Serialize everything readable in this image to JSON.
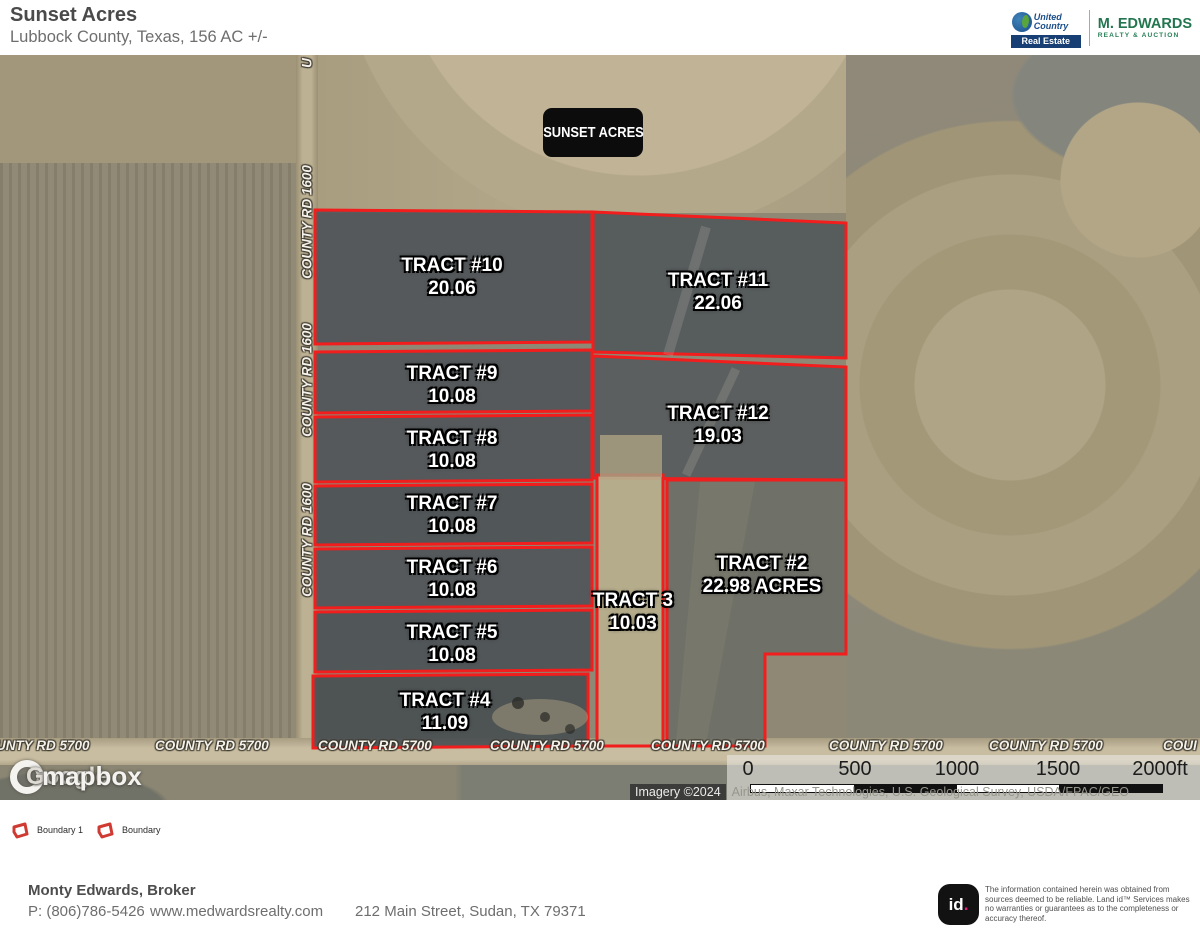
{
  "header": {
    "title": "Sunset Acres",
    "subtitle": "Lubbock County, Texas, 156 AC +/-",
    "logos": {
      "united_line1": "United",
      "united_line2": "Country",
      "united_line3": "Real Estate",
      "medwards_line1": "M. EDWARDS",
      "medwards_line2": "REALTY & AUCTION"
    }
  },
  "map": {
    "badge": "SUNSET ACRES",
    "tracts": [
      {
        "name": "TRACT #10",
        "acres": "20.06"
      },
      {
        "name": "TRACT #11",
        "acres": "22.06"
      },
      {
        "name": "TRACT #9",
        "acres": "10.08"
      },
      {
        "name": "TRACT #12",
        "acres": "19.03"
      },
      {
        "name": "TRACT #8",
        "acres": "10.08"
      },
      {
        "name": "TRACT #7",
        "acres": "10.08"
      },
      {
        "name": "TRACT #6",
        "acres": "10.08"
      },
      {
        "name": "TRACT #5",
        "acres": "10.08"
      },
      {
        "name": "TRACT #4",
        "acres": "11.09"
      },
      {
        "name": "TRACT 3",
        "acres": "10.03"
      },
      {
        "name": "TRACT #2",
        "acres": "22.98 ACRES"
      }
    ],
    "roads": {
      "vertical_label": "COUNTY RD 1600",
      "vertical_label_top_clipped": "U",
      "horizontal_label": "COUNTY RD 5700",
      "horizontal_label_left_clipped": "UNTY RD 5700",
      "horizontal_label_right_clipped": "COUI"
    },
    "watermark": {
      "google_text": "Google",
      "mapbox_text": "mapbox"
    },
    "scalebar": {
      "ticks": [
        "0",
        "500",
        "1000",
        "1500",
        "2000ft"
      ]
    },
    "attribution": {
      "imagery": "Imagery ©2024",
      "sources": "Airbus, Maxar Technologies, U.S. Geological Survey, USDA/FPAC/GEO"
    }
  },
  "legend": {
    "items": [
      {
        "label": "Boundary 1"
      },
      {
        "label": "Boundary"
      }
    ]
  },
  "footer": {
    "broker": "Monty Edwards, Broker",
    "phone": "P: (806)786-5426",
    "website": "www.medwardsrealty.com",
    "address": "212 Main Street, Sudan, TX 79371",
    "landid_logo_id": "id",
    "landid_logo_dot": ".",
    "disclaimer_line1": "The information contained herein was obtained from sources deemed to be reliable.",
    "disclaimer_line2": "Land id™ Services makes no warranties or guarantees as to the completeness or accuracy thereof."
  },
  "colors": {
    "boundary_red": "#f21d1d",
    "badge_black": "#0c0c0c",
    "landid_dot_pink": "#e61e7b",
    "united_country_blue": "#1b4e8a",
    "medwards_green": "#22764f"
  }
}
